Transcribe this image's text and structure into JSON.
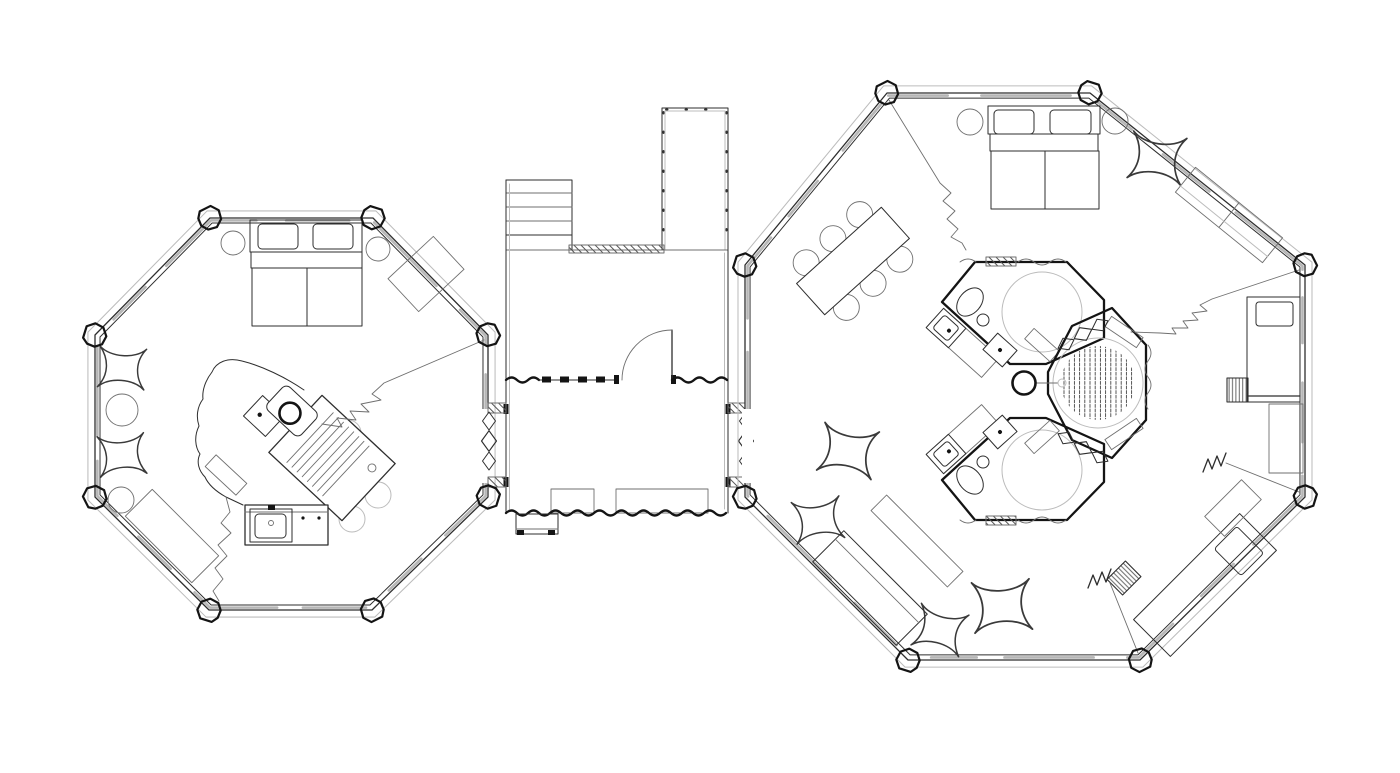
{
  "canvas": {
    "width": 1400,
    "height": 773,
    "background": "#ffffff"
  },
  "palette": {
    "ink": "#2e2e2e",
    "ink_strong": "#141414",
    "ink_soft": "#6f6f6f",
    "line_faint": "#bcbcbc",
    "wall_band": "#a9a9a9",
    "paper": "#ffffff",
    "hatch": "#555555"
  },
  "drawing": {
    "type": "architectural-floor-plan",
    "structures": [
      {
        "id": "left-cabin",
        "shape": "octagon",
        "elements": [
          "double-bed",
          "pillows",
          "nightstand-circles",
          "wall-rug",
          "star-poufs",
          "side-table-circle",
          "island-cloud",
          "cooktop-strip",
          "prep-square",
          "grill-table",
          "chair-circles",
          "kitchen-counter-sink",
          "wall-bench",
          "leader-zigzags",
          "corner-posts"
        ]
      },
      {
        "id": "entry-link",
        "shape": "rect-corridor",
        "elements": [
          "roof-deck-outline",
          "staircase",
          "hatched-wall",
          "entry-door-swing",
          "wavy-log-walls",
          "threshold-mats",
          "entry-stoop",
          "accordion-connectors"
        ]
      },
      {
        "id": "right-cabin",
        "shape": "octagon",
        "elements": [
          "double-bed",
          "pillows",
          "nightstand-circles",
          "star-poufs",
          "wall-bench-two-seat",
          "dining-table-six-chairs",
          "daybed-east",
          "daybed-southeast",
          "hatched-stools",
          "sofa-southwest",
          "floor-rug",
          "wc-pod-upper",
          "wc-pod-lower",
          "shower-pod",
          "center-column",
          "spring-symbols",
          "leader-zigzags",
          "corner-posts"
        ]
      }
    ]
  }
}
